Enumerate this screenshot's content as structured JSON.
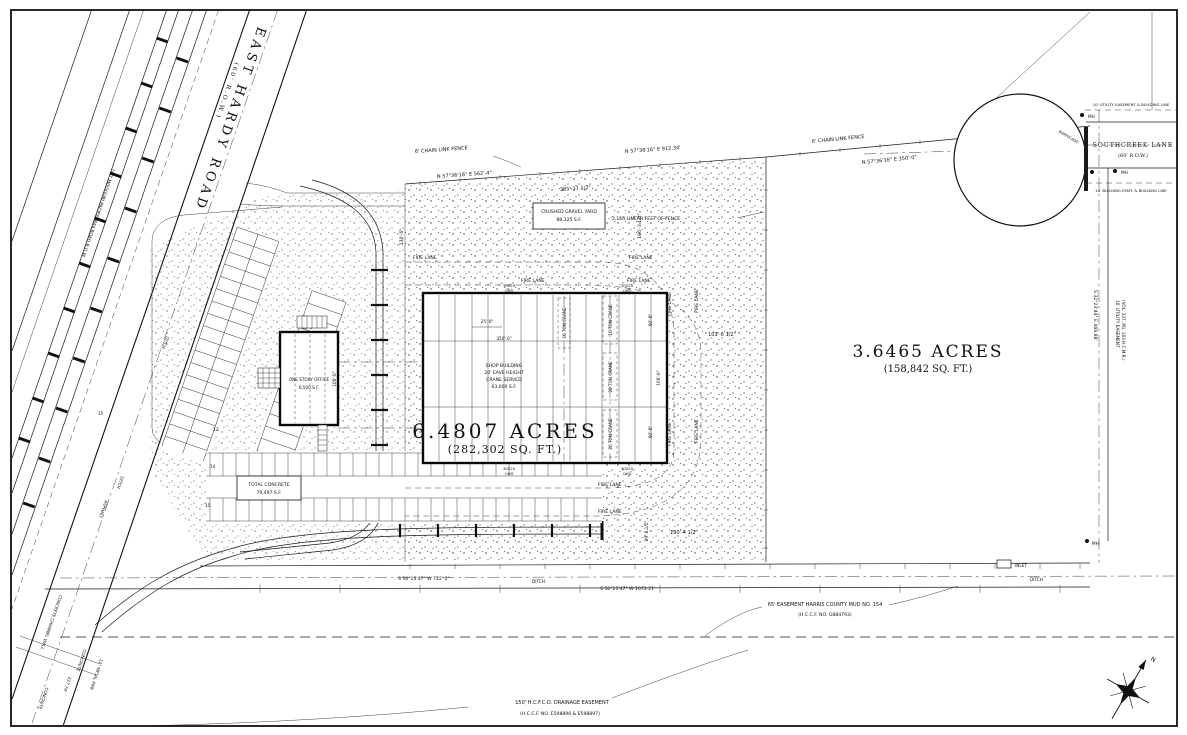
{
  "roads": {
    "east_hardy_name": "EAST HARDY ROAD",
    "east_hardy_row": "(60' R.O.W.)",
    "southcreek_name": "SOUTHCREEK LANE",
    "southcreek_row": "(60' R.O.W.)",
    "railroad_row": "100' MISSOURI PACIFIC RAILROAD R.O.W."
  },
  "parcels": {
    "main_acres": "6.4807 ACRES",
    "main_sqft": "(282,302 SQ. FT.)",
    "east_acres": "3.6465 ACRES",
    "east_sqft": "(158,842 SQ. FT.)"
  },
  "shop": {
    "line1": "SHOP BUILDING",
    "line2": "20' EAVE HEIGHT",
    "line3": "CRANE SERVED",
    "line4": "63,000 S.F."
  },
  "office": {
    "line1": "ONE STORY OFFICE",
    "line2": "6,500 S.F."
  },
  "areas": {
    "gravel_line1": "CRUSHED GRAVEL YARD",
    "gravel_line2": "88,325 S.F.",
    "concrete_line1": "TOTAL CONCRETE",
    "concrete_line2": "79,497 S.F."
  },
  "fence": {
    "chain_link": "6' CHAIN LINK FENCE",
    "total": "2,154 LINEAR FEET OF FENCE"
  },
  "bearings": {
    "n1": "N 57°36'16\" E   562'-4\"",
    "n2": "N 57°36'16\" E   912.34'",
    "n3": "N 57°36'16\" E   350'-0\"",
    "s1": "S 56°15'47\" W   722'-2\"",
    "s2": "S 56°15'47\" W   1072.21'",
    "e1": "S 32°23'44\" E   469.88'"
  },
  "easements": {
    "mud_line1": "65' EASEMENT HARRIS COUNTY MUD NO. 154",
    "mud_line2": "(H.C.C.F. NO. G884793)",
    "drain_line1": "150' H.C.F.C.D. DRAINAGE EASEMENT",
    "drain_line2": "(H.C.C.F. NO. E598896 & E598897)",
    "utility_r1": "10' UTILITY EASEMENT",
    "utility_r2": "(VOL. 327, PG. 103 H.C.M.R.)"
  },
  "street": {
    "utility_top": "10' UTILITY EASEMENT & BUILDING LINE",
    "building_line": "16' BUILDING ESMT. & BUILDING LINE",
    "barricade": "BARRICADE",
    "mh": "MH",
    "inlet": "INLET",
    "ditch": "DITCH"
  },
  "cranes": {
    "ten": "10 TON CRANE",
    "twenty": "20 TON CRANE"
  },
  "doors": {
    "size": "30X20",
    "ohd": "OHD"
  },
  "firelane": {
    "label": "FIRE LANE"
  },
  "dims": {
    "d385": "385'-11 1/2\"",
    "d101": "101'-6 1/2\"",
    "d196": "196'-3 1/2\"",
    "d190": "190'-4 1/2\"",
    "d99": "99'-8 1/2\"",
    "d25": "25'-0\"",
    "d350": "350'-0\"",
    "d65": "65'-0\"",
    "d100": "100'-0\"",
    "d60": "60'-0\"",
    "d160": "160'-0\"",
    "d130": "130'-6\"",
    "d227": "227.74'"
  },
  "sitework": {
    "concrete": "CONCRETE",
    "channel_wall": "CONCRETE CHANNEL WALL",
    "metal_pipe": "12\" METAL PIPE",
    "asphalt": "ASPHALT"
  },
  "parking": {
    "c13": "13",
    "c14": "14",
    "c15": "15"
  },
  "compass": {
    "north": "N"
  }
}
